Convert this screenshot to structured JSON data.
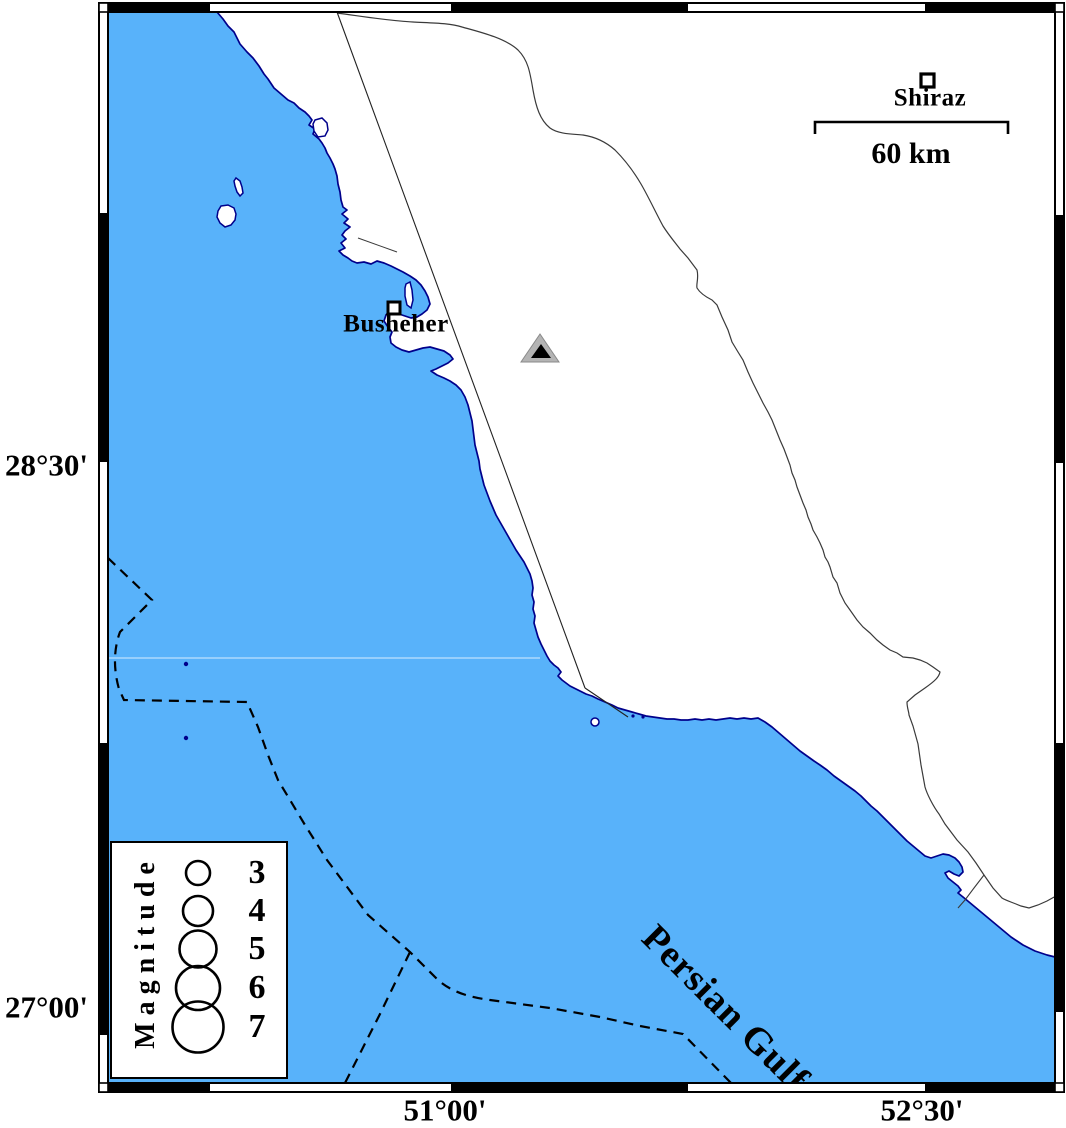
{
  "map_title": "Busheher region seismicity map",
  "axis": {
    "lat": [
      {
        "label": "28°30'"
      },
      {
        "label": "27°00'"
      }
    ],
    "lon": [
      {
        "label": "51°00'"
      },
      {
        "label": "52°30'"
      }
    ]
  },
  "cities": {
    "busheher": "Busheher",
    "shiraz": "Shiraz"
  },
  "site_marker": "power-plant-site-triangle",
  "scale_bar": {
    "label": "60 km"
  },
  "sea_label": "Persian Gulf",
  "legend": {
    "title": "Magnitude",
    "entries": [
      {
        "label": "3"
      },
      {
        "label": "4"
      },
      {
        "label": "5"
      },
      {
        "label": "6"
      },
      {
        "label": "7"
      }
    ]
  },
  "colors": {
    "sea": "#58B2FA",
    "coastline": "#00008B",
    "land": "#FFFFFF",
    "frame": "#000000",
    "triangle_fill": "#B4B4B4",
    "triangle_core": "#000000",
    "inland_line": "#3A3A3A"
  }
}
